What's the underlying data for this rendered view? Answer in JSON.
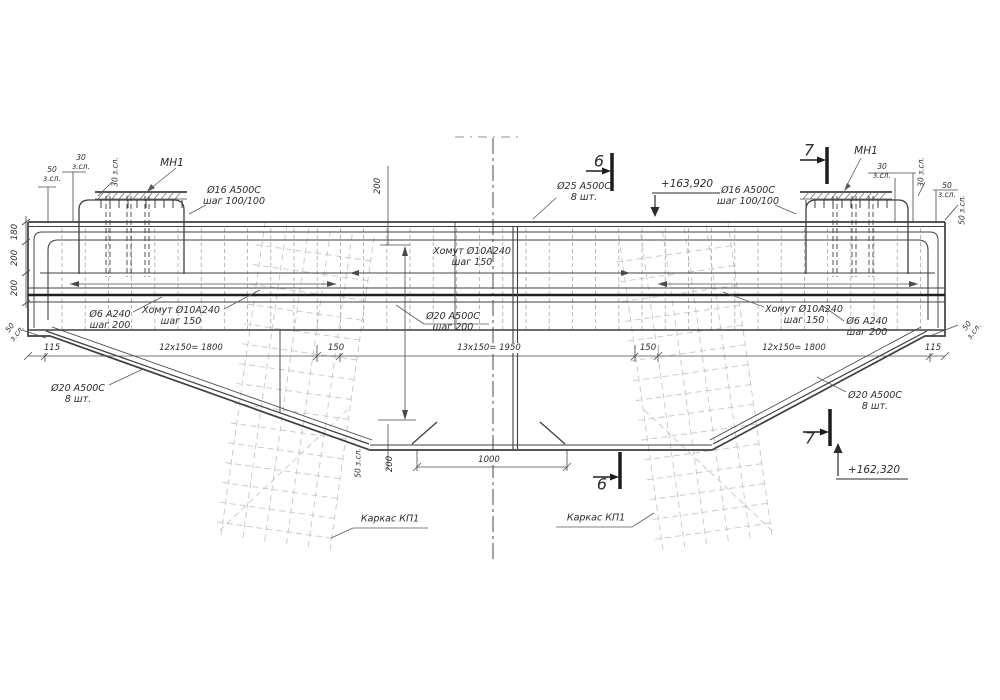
{
  "drawing": {
    "title_hint": "reinforced concrete pier cap elevation with rebar callouts",
    "colors": {
      "background": "#ffffff",
      "main_line": "#3f3f3f",
      "dark_bar": "#1f1f1f",
      "dim_line": "#4a4a4a",
      "faint_cage": "#c6c6c6",
      "stirrup": "#a9a9a9",
      "text": "#2d2d2d"
    },
    "labels": [
      {
        "name": "label-mn1-left",
        "text": "МН1",
        "x": 172,
        "y": 163,
        "size": 10.5
      },
      {
        "name": "label-mn1-right",
        "text": "МН1",
        "x": 866,
        "y": 151,
        "size": 10.5
      },
      {
        "name": "label-d16-left",
        "text": "Ø16 A500C\nшаг 100/100",
        "x": 234,
        "y": 196
      },
      {
        "name": "label-d16-right",
        "text": "Ø16 A500C\nшаг 100/100",
        "x": 748,
        "y": 196
      },
      {
        "name": "label-d25",
        "text": "Ø25 A500C\n8 шт.",
        "x": 584,
        "y": 192
      },
      {
        "name": "label-elev-top",
        "text": "+163,920",
        "x": 687,
        "y": 184,
        "size": 10.5
      },
      {
        "name": "label-elev-bottom",
        "text": "+162,320",
        "x": 874,
        "y": 470,
        "size": 10.5
      },
      {
        "name": "section-6-top",
        "text": "6",
        "x": 599,
        "y": 162,
        "size": 16
      },
      {
        "name": "section-7-top",
        "text": "7",
        "x": 809,
        "y": 151,
        "size": 16
      },
      {
        "name": "section-6-bottom",
        "text": "6",
        "x": 602,
        "y": 485,
        "size": 16
      },
      {
        "name": "section-7-bottom",
        "text": "7",
        "x": 810,
        "y": 439,
        "size": 16
      },
      {
        "name": "label-stirrup-center",
        "text": "Хомут Ø10A240\nшаг 150",
        "x": 472,
        "y": 257
      },
      {
        "name": "label-stirrup-left",
        "text": "Хомут Ø10A240\nшаг 150",
        "x": 181,
        "y": 316
      },
      {
        "name": "label-stirrup-right",
        "text": "Хомут Ø10A240\nшаг 150",
        "x": 804,
        "y": 315
      },
      {
        "name": "label-d6-left",
        "text": "Ø6 A240\nшаг 200",
        "x": 110,
        "y": 320
      },
      {
        "name": "label-d6-right",
        "text": "Ø6 A240\nшаг 200",
        "x": 867,
        "y": 327
      },
      {
        "name": "label-d20-center",
        "text": "Ø20 A500C\nшаг 200",
        "x": 453,
        "y": 322
      },
      {
        "name": "label-d20-left",
        "text": "Ø20 A500C\n8 шт.",
        "x": 78,
        "y": 394
      },
      {
        "name": "label-d20-right",
        "text": "Ø20 A500C\n8 шт.",
        "x": 875,
        "y": 401
      },
      {
        "name": "label-karkas-left",
        "text": "Каркас КП1",
        "x": 390,
        "y": 519
      },
      {
        "name": "label-karkas-right",
        "text": "Каркас КП1",
        "x": 596,
        "y": 518
      },
      {
        "name": "dim-115-left",
        "text": "115",
        "x": 52,
        "y": 348,
        "size": 8.5,
        "bg": true
      },
      {
        "name": "dim-1800-left",
        "text": "12x150= 1800",
        "x": 191,
        "y": 348,
        "size": 8.5,
        "bg": true
      },
      {
        "name": "dim-150-left",
        "text": "150",
        "x": 336,
        "y": 348,
        "size": 8.5,
        "bg": true
      },
      {
        "name": "dim-1950-center",
        "text": "13x150= 1950",
        "x": 489,
        "y": 348,
        "size": 8.5,
        "bg": true
      },
      {
        "name": "dim-150-right",
        "text": "150",
        "x": 648,
        "y": 348,
        "size": 8.5,
        "bg": true
      },
      {
        "name": "dim-1800-right",
        "text": "12x150= 1800",
        "x": 794,
        "y": 348,
        "size": 8.5,
        "bg": true
      },
      {
        "name": "dim-115-right",
        "text": "115",
        "x": 933,
        "y": 348,
        "size": 8.5,
        "bg": true
      },
      {
        "name": "dim-1000",
        "text": "1000",
        "x": 489,
        "y": 460,
        "size": 8.5,
        "bg": true
      },
      {
        "name": "dim-180-left",
        "text": "180",
        "x": 15,
        "y": 232,
        "rot": -90,
        "size": 8.5
      },
      {
        "name": "dim-200a-left",
        "text": "200",
        "x": 15,
        "y": 258,
        "rot": -90,
        "size": 8.5
      },
      {
        "name": "dim-200b-left",
        "text": "200",
        "x": 15,
        "y": 288,
        "rot": -90,
        "size": 8.5
      },
      {
        "name": "dim-200-top",
        "text": "200",
        "x": 378,
        "y": 186,
        "rot": -90,
        "size": 8.5
      },
      {
        "name": "dim-200-bottom",
        "text": "200",
        "x": 390,
        "y": 464,
        "rot": -90,
        "size": 8.5
      },
      {
        "name": "dim-50-bottom",
        "text": "50 з.сл.",
        "x": 359,
        "y": 463,
        "rot": -90,
        "size": 7.5
      },
      {
        "name": "cover-30-left",
        "text": "30\nз.сл.",
        "x": 81,
        "y": 163,
        "size": 7.5
      },
      {
        "name": "cover-50-left",
        "text": "50\nз.сл.",
        "x": 52,
        "y": 175,
        "size": 7.5
      },
      {
        "name": "cover-30-left-rot",
        "text": "30 з.сл.",
        "x": 116,
        "y": 172,
        "rot": -90,
        "size": 7.5
      },
      {
        "name": "cover-30-right",
        "text": "30\nз.сл.",
        "x": 882,
        "y": 172,
        "size": 7.5
      },
      {
        "name": "cover-30-right-rot",
        "text": "30 з.сл.",
        "x": 922,
        "y": 172,
        "rot": -90,
        "size": 7.5
      },
      {
        "name": "cover-50-right",
        "text": "50\nз.сл.",
        "x": 947,
        "y": 191,
        "size": 7.5
      },
      {
        "name": "cover-50-right-rot",
        "text": "50 з.сл.",
        "x": 963,
        "y": 210,
        "rot": -90,
        "size": 7.5
      },
      {
        "name": "cover-50-taper-left",
        "text": "50\nз.сл.",
        "x": 14,
        "y": 331,
        "rot": -52,
        "size": 7.5
      },
      {
        "name": "cover-50-taper-right",
        "text": "50\nз.сл.",
        "x": 971,
        "y": 329,
        "rot": -52,
        "size": 7.5
      }
    ],
    "generated": {
      "stirrups": {
        "x0": 62,
        "x1": 936,
        "step": 23.2,
        "y0": 228,
        "y1": 329,
        "color": "#a9a9a9",
        "dash": "4,3",
        "w": 0.8
      },
      "cages": [
        {
          "angle": 8,
          "cx": 298,
          "cy": 390,
          "vx0": 242,
          "vn": 6,
          "vstep": 22,
          "vy0": 228,
          "vy1": 548,
          "rx0": 236,
          "rx1": 356,
          "ry0": 252,
          "rn": 15,
          "rstep": 20,
          "diag": [
            240,
            540,
            352,
            400
          ]
        },
        {
          "angle": -8,
          "cx": 697,
          "cy": 390,
          "vx0": 641,
          "vn": 6,
          "vstep": 22,
          "vy0": 228,
          "vy1": 548,
          "rx0": 635,
          "rx1": 755,
          "ry0": 252,
          "rn": 15,
          "rstep": 20,
          "diag": [
            752,
            540,
            640,
            400
          ]
        }
      ],
      "embeds": [
        {
          "strip_x": 95,
          "strip_w": 92,
          "loop_l": 79,
          "loop_r": 184,
          "pairs": [
            106,
            110,
            127,
            131,
            145,
            149
          ]
        },
        {
          "strip_x": 800,
          "strip_w": 92,
          "loop_l": 806,
          "loop_r": 908,
          "pairs": [
            833,
            837,
            852,
            856,
            869,
            873
          ]
        }
      ],
      "cage_color": "#c6c6c6"
    }
  }
}
